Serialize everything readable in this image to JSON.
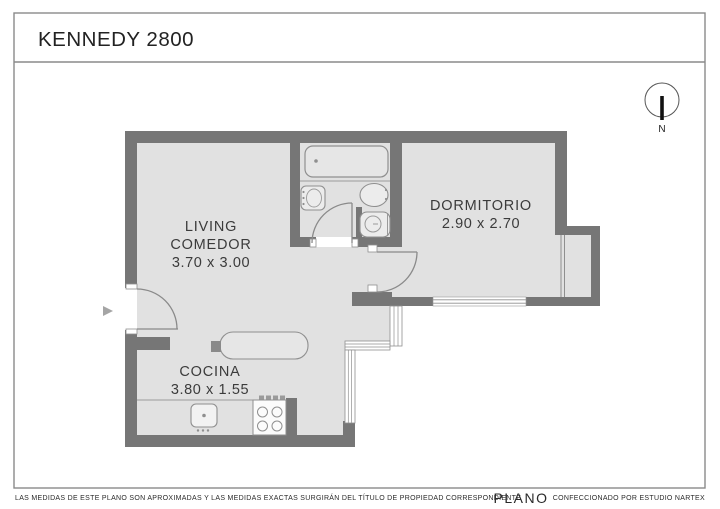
{
  "header": {
    "title": "KENNEDY 2800"
  },
  "compass": {
    "label": "N"
  },
  "rooms": [
    {
      "id": "living",
      "name_line1": "LIVING",
      "name_line2": "COMEDOR",
      "dimensions": "3.70 x 3.00"
    },
    {
      "id": "dormitorio",
      "name": "DORMITORIO",
      "dimensions": "2.90 x 2.70"
    },
    {
      "id": "cocina",
      "name": "COCINA",
      "dimensions": "3.80 x 1.55"
    }
  ],
  "footer": {
    "disclaimer": "LAS MEDIDAS  DE ESTE PLANO SON APROXIMADAS Y LAS MEDIDAS EXACTAS SURGIRÁN DEL TÍTULO DE PROPIEDAD CORRESPONDIENTE",
    "plan_label": "PLANO",
    "credit": "CONFECCIONADO POR ESTUDIO NARTEX"
  },
  "colors": {
    "wall": "#767676",
    "floor": "#e1e1e1",
    "fixture_line": "#8f8f8f",
    "text": "#3b3b3b",
    "frame": "#8a8a8a"
  }
}
